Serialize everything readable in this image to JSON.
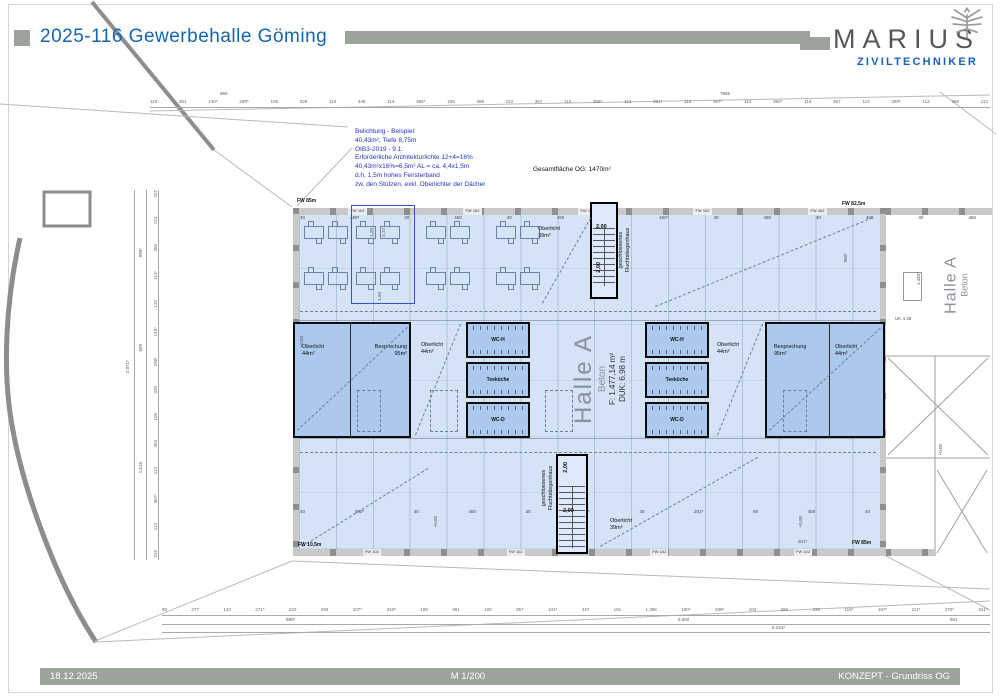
{
  "header": {
    "title": "2025-116 Gewerbehalle Göming",
    "brand": "MARIUS",
    "brand_sub": "ZIVILTECHNIKER",
    "eagle_icon": "austrian-eagle"
  },
  "footer": {
    "date": "18.12.2025",
    "scale": "M 1/200",
    "sheet": "KONZEPT - Grundriss OG"
  },
  "notes": {
    "belichtung": [
      "Belichtung - Beispiel:",
      "40,43m², Tiefe 8,75m",
      "OIB3-2019 - 9.1:",
      "Erforderliche Architekturlichte 12+4=16%",
      "40,43m²x16%=6,5m² AL = ca. 4,4x1,5m",
      "d.h. 1,5m hohes Fensterband",
      "zw. den Stützen, exkl. Oberlichter der Dächer"
    ],
    "total_area": "Gesamtfläche OG:  1470m²"
  },
  "hall": {
    "name": "Halle A",
    "material": "Beton",
    "area": "F: 1.477,14 m²",
    "duk": "DUK: 6,98 m"
  },
  "hall_right": {
    "name": "Halle A",
    "material": "Beton"
  },
  "rooms": {
    "besprechung_name": "Besprechung",
    "besprechung_area": "95m²",
    "oberlicht_name": "Oberlicht",
    "oberlicht44_area": "44m²",
    "oberlicht39_area": "39m²",
    "wc_h": "WC-H",
    "teekueche": "Teeküche",
    "wc_d": "WC-D"
  },
  "stair": {
    "line1": "geschlossenes",
    "line2": "Fluchtstiegenhaus",
    "width": "2,00"
  },
  "site": {
    "fw_top_left": "FW 85m",
    "fw_top_right": "FW 82,5m",
    "fw_bottom_left": "FW 10,5m",
    "fw_bottom_right": "FW 85m",
    "level_zero": "+0,00",
    "uk": "UK 4,48"
  },
  "walls": {
    "tags_top": [
      "FW 102",
      "FW 102",
      "FW 102",
      "FW 102",
      "FW 102"
    ],
    "tags_bottom": [
      "FW 102",
      "FW 102",
      "FW 102",
      "FW 102"
    ]
  },
  "dims": {
    "top": [
      "119",
      "301",
      "140⁵",
      "299⁵",
      "109",
      "229",
      "113",
      "348",
      "113",
      "366⁵",
      "108",
      "369",
      "113",
      "367",
      "113",
      "366⁵",
      "113",
      "361⁵",
      "113",
      "367⁵",
      "112",
      "360⁵",
      "113",
      "367",
      "113",
      "369⁵",
      "113",
      "366",
      "113"
    ],
    "top_total_left": "660",
    "top_total_right": "7665",
    "bottom": [
      "90",
      "277",
      "132",
      "271⁵",
      "222",
      "293",
      "107⁵",
      "343⁵",
      "105",
      "391",
      "100",
      "357",
      "101⁵",
      "447",
      "101",
      "1.398",
      "100⁵",
      "339⁵",
      "104",
      "282",
      "330",
      "115⁵",
      "187⁵",
      "111⁵",
      "270⁵",
      "341⁵"
    ],
    "bottom_total_1": "990⁵",
    "bottom_total_2": "5.002",
    "bottom_total_3": "8.244⁵",
    "bottom_total_4": "901",
    "left": [
      "327",
      "113",
      "366",
      "114⁵",
      "132",
      "148⁵",
      "298⁵",
      "320",
      "100",
      "404",
      "113",
      "367⁵",
      "113",
      "215"
    ],
    "left_total_1": "999⁵",
    "left_total_2": "599",
    "left_total_3": "1.516",
    "left_total_4": "2.071⁵",
    "inner_top": [
      "40",
      "460⁵",
      "40",
      "460",
      "40",
      "460",
      "40",
      "460⁵",
      "40",
      "460",
      "40",
      "460",
      "40",
      "460"
    ],
    "inner_bottom": [
      "40",
      "460⁵",
      "40",
      "460",
      "40",
      "459⁵",
      "40",
      "201⁵",
      "60",
      "450",
      "40"
    ],
    "v_960": "960⁵",
    "v_1440": "1.440⁵",
    "d_201": "201⁵",
    "hl_w": "1,20",
    "hl_h": "5,73",
    "hl_b": "1,50"
  },
  "colors": {
    "bar_sage": "#9ca39b",
    "title_blue": "#1565af",
    "brand_blue": "#1a5fc4",
    "plan_fill": "#d4e3f6",
    "room_fill": "#abc9ed",
    "note_blue": "#2233cc",
    "wall_gray": "#8f8f8f"
  }
}
